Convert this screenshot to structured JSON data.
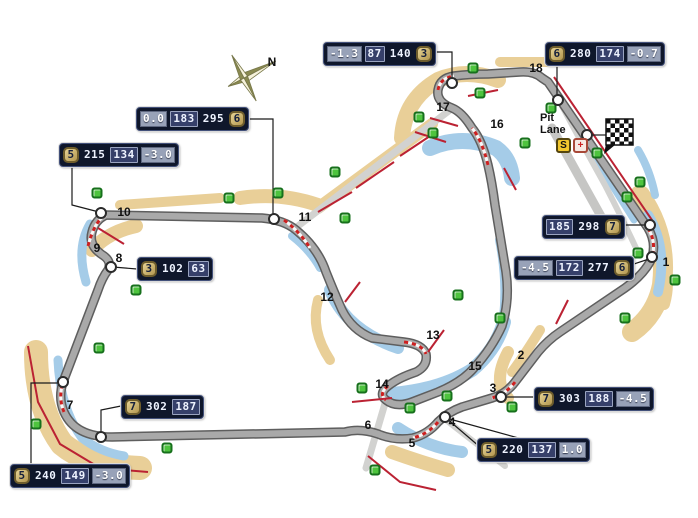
{
  "canvas": {
    "width": 698,
    "height": 518,
    "background": "#ffffff"
  },
  "colors": {
    "track": "#a9a9a9",
    "track_edge": "#5e5e5e",
    "access_road": "#d2d2d0",
    "runoff_tan": "#e9cf98",
    "runoff_blue": "#a5cce8",
    "curb_red": "#cc2020",
    "barrier_red": "#bb2233",
    "marshal_green": "#4ec43e",
    "marker_white": "#ffffff",
    "box_bg": "#0f172b",
    "cell_mid_bg": "#36406a",
    "cell_light_bg": "#98a2b8",
    "gear_bg": "#c9b274",
    "digit_color": "#eef3ff"
  },
  "compass": {
    "label": "N"
  },
  "pit": {
    "label_line1": "Pit",
    "label_line2": "Lane",
    "start_badge": "S",
    "medical_badge": "+"
  },
  "flag": {
    "icon": "checkered-flag"
  },
  "corners": [
    {
      "n": "1",
      "x": 666,
      "y": 262
    },
    {
      "n": "2",
      "x": 521,
      "y": 355
    },
    {
      "n": "3",
      "x": 493,
      "y": 388
    },
    {
      "n": "4",
      "x": 452,
      "y": 422
    },
    {
      "n": "5",
      "x": 412,
      "y": 443
    },
    {
      "n": "6",
      "x": 368,
      "y": 425
    },
    {
      "n": "7",
      "x": 70,
      "y": 405
    },
    {
      "n": "8",
      "x": 119,
      "y": 258
    },
    {
      "n": "9",
      "x": 97,
      "y": 248
    },
    {
      "n": "10",
      "x": 124,
      "y": 212
    },
    {
      "n": "11",
      "x": 305,
      "y": 217
    },
    {
      "n": "12",
      "x": 327,
      "y": 297
    },
    {
      "n": "13",
      "x": 433,
      "y": 335
    },
    {
      "n": "14",
      "x": 382,
      "y": 384
    },
    {
      "n": "15",
      "x": 475,
      "y": 366
    },
    {
      "n": "16",
      "x": 497,
      "y": 124
    },
    {
      "n": "17",
      "x": 443,
      "y": 107
    },
    {
      "n": "18",
      "x": 536,
      "y": 68
    }
  ],
  "markers": [
    {
      "x": 452,
      "y": 83
    },
    {
      "x": 558,
      "y": 100
    },
    {
      "x": 587,
      "y": 135
    },
    {
      "x": 650,
      "y": 225
    },
    {
      "x": 652,
      "y": 257
    },
    {
      "x": 501,
      "y": 397
    },
    {
      "x": 445,
      "y": 417
    },
    {
      "x": 101,
      "y": 437
    },
    {
      "x": 63,
      "y": 382
    },
    {
      "x": 111,
      "y": 267
    },
    {
      "x": 101,
      "y": 213
    },
    {
      "x": 274,
      "y": 219
    }
  ],
  "marshal_posts": [
    {
      "x": 97,
      "y": 193
    },
    {
      "x": 136,
      "y": 290
    },
    {
      "x": 99,
      "y": 348
    },
    {
      "x": 36,
      "y": 424
    },
    {
      "x": 167,
      "y": 448
    },
    {
      "x": 229,
      "y": 198
    },
    {
      "x": 278,
      "y": 193
    },
    {
      "x": 335,
      "y": 172
    },
    {
      "x": 345,
      "y": 218
    },
    {
      "x": 362,
      "y": 388
    },
    {
      "x": 375,
      "y": 470
    },
    {
      "x": 410,
      "y": 408
    },
    {
      "x": 447,
      "y": 396
    },
    {
      "x": 458,
      "y": 295
    },
    {
      "x": 500,
      "y": 318
    },
    {
      "x": 512,
      "y": 407
    },
    {
      "x": 419,
      "y": 117
    },
    {
      "x": 433,
      "y": 133
    },
    {
      "x": 473,
      "y": 68
    },
    {
      "x": 480,
      "y": 93
    },
    {
      "x": 525,
      "y": 143
    },
    {
      "x": 551,
      "y": 108
    },
    {
      "x": 597,
      "y": 153
    },
    {
      "x": 640,
      "y": 182
    },
    {
      "x": 627,
      "y": 197
    },
    {
      "x": 638,
      "y": 253
    },
    {
      "x": 675,
      "y": 280
    },
    {
      "x": 625,
      "y": 318
    }
  ],
  "info_boxes": [
    {
      "id": "turn17",
      "x": 323,
      "y": 42,
      "cells": [
        {
          "t": "-1.3",
          "k": "light"
        },
        {
          "t": "87",
          "k": "mid"
        },
        {
          "t": "140",
          "k": "plain"
        },
        {
          "t": "3",
          "k": "gear"
        }
      ]
    },
    {
      "id": "turn18",
      "x": 545,
      "y": 42,
      "cells": [
        {
          "t": "6",
          "k": "gear"
        },
        {
          "t": "280",
          "k": "plain"
        },
        {
          "t": "174",
          "k": "mid"
        },
        {
          "t": "-0.7",
          "k": "light"
        }
      ]
    },
    {
      "id": "turn11",
      "x": 136,
      "y": 107,
      "cells": [
        {
          "t": "0.0",
          "k": "light"
        },
        {
          "t": "183",
          "k": "mid"
        },
        {
          "t": "295",
          "k": "plain"
        },
        {
          "t": "6",
          "k": "gear"
        }
      ]
    },
    {
      "id": "turn10",
      "x": 59,
      "y": 143,
      "cells": [
        {
          "t": "5",
          "k": "gear"
        },
        {
          "t": "215",
          "k": "plain"
        },
        {
          "t": "134",
          "k": "mid"
        },
        {
          "t": "-3.0",
          "k": "light"
        }
      ]
    },
    {
      "id": "turn8",
      "x": 137,
      "y": 257,
      "cells": [
        {
          "t": "3",
          "k": "gear"
        },
        {
          "t": "102",
          "k": "plain"
        },
        {
          "t": "63",
          "k": "mid"
        }
      ]
    },
    {
      "id": "back-straight",
      "x": 121,
      "y": 395,
      "cells": [
        {
          "t": "7",
          "k": "gear"
        },
        {
          "t": "302",
          "k": "plain"
        },
        {
          "t": "187",
          "k": "mid"
        }
      ]
    },
    {
      "id": "turn7",
      "x": 10,
      "y": 464,
      "cells": [
        {
          "t": "5",
          "k": "gear"
        },
        {
          "t": "240",
          "k": "plain"
        },
        {
          "t": "149",
          "k": "mid"
        },
        {
          "t": "-3.0",
          "k": "light"
        }
      ]
    },
    {
      "id": "turn4",
      "x": 477,
      "y": 438,
      "cells": [
        {
          "t": "5",
          "k": "gear"
        },
        {
          "t": "220",
          "k": "plain"
        },
        {
          "t": "137",
          "k": "mid"
        },
        {
          "t": "1.0",
          "k": "light"
        }
      ]
    },
    {
      "id": "turn3",
      "x": 534,
      "y": 387,
      "cells": [
        {
          "t": "7",
          "k": "gear"
        },
        {
          "t": "303",
          "k": "plain"
        },
        {
          "t": "188",
          "k": "mid"
        },
        {
          "t": "-4.5",
          "k": "light"
        }
      ]
    },
    {
      "id": "main-straight",
      "x": 542,
      "y": 215,
      "cells": [
        {
          "t": "185",
          "k": "mid"
        },
        {
          "t": "298",
          "k": "plain"
        },
        {
          "t": "7",
          "k": "gear"
        }
      ]
    },
    {
      "id": "turn1",
      "x": 514,
      "y": 256,
      "cells": [
        {
          "t": "-4.5",
          "k": "light"
        },
        {
          "t": "172",
          "k": "mid"
        },
        {
          "t": "277",
          "k": "plain"
        },
        {
          "t": "6",
          "k": "gear"
        }
      ]
    }
  ]
}
